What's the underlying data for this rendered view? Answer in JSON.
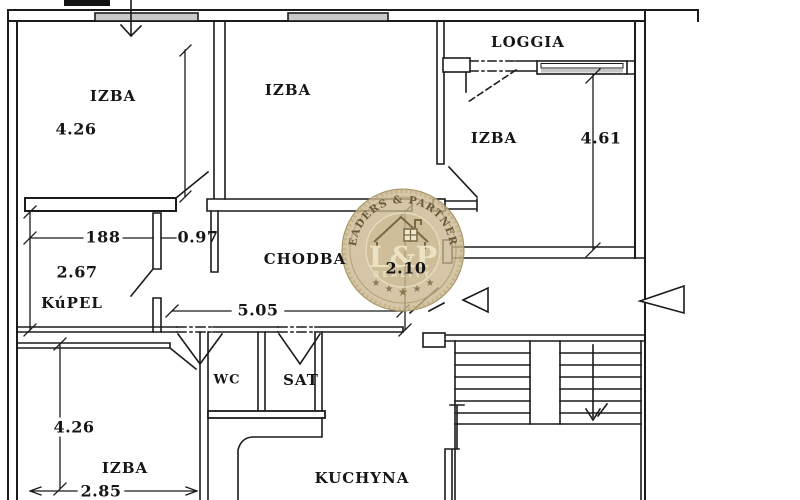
{
  "plan": {
    "rooms": [
      {
        "label": "IZBA"
      },
      {
        "label": "IZBA"
      },
      {
        "label": "LOGGIA"
      },
      {
        "label": "IZBA"
      },
      {
        "label": "KúPEL"
      },
      {
        "label": "CHODBA"
      },
      {
        "label": "WC"
      },
      {
        "label": "SAT"
      },
      {
        "label": "IZBA"
      },
      {
        "label": "KUCHYNA"
      }
    ],
    "dimensions": [
      {
        "label": "4.26"
      },
      {
        "label": "4.61"
      },
      {
        "label": "188"
      },
      {
        "label": "0.97"
      },
      {
        "label": "2.67"
      },
      {
        "label": "2.10"
      },
      {
        "label": "5.05"
      },
      {
        "label": "4.26"
      },
      {
        "label": "2.85"
      }
    ]
  },
  "watermark": {
    "arc_text": "LEADERS & PARTNERS",
    "monogram": "L&P",
    "subtitle": "REALITY",
    "star": "★",
    "colors": {
      "badge": "#c8b68d",
      "ring": "#a08c5e",
      "arc_text": "#6b5a3c",
      "monogram": "#ece2c2"
    }
  },
  "canvas": {
    "line_color": "#1b1b1b",
    "background": "#ffffff"
  }
}
